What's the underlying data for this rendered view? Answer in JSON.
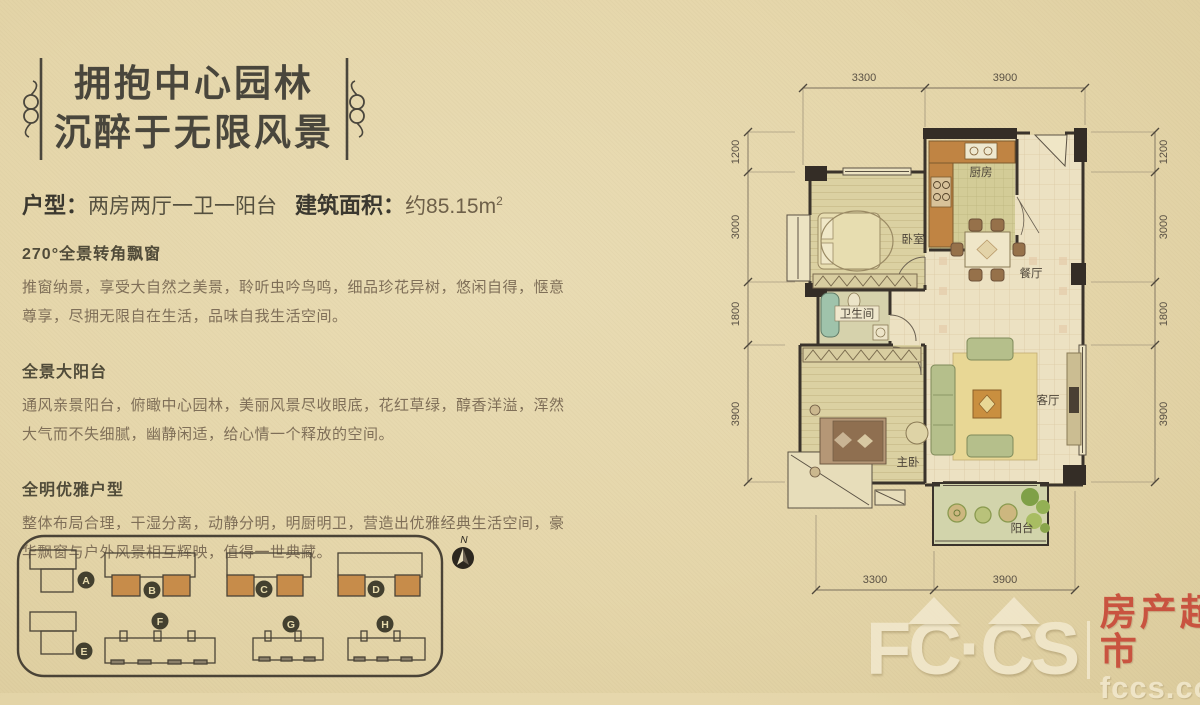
{
  "header": {
    "line1": "拥抱中心园林",
    "line2": "沉醉于无限风景"
  },
  "summary": {
    "type_label": "户型",
    "type_colon": "：",
    "type_value": "两房两厅一卫一阳台",
    "area_label": "建筑面积",
    "area_colon": "：",
    "area_value": "约85.15m",
    "area_sup": "2"
  },
  "sections": [
    {
      "heading": "270°全景转角飘窗",
      "body": "推窗纳景，享受大自然之美景，聆听虫吟鸟鸣，细品珍花异树，悠闲自得，惬意尊享，尽拥无限自在生活，品味自我生活空间。"
    },
    {
      "heading": "全景大阳台",
      "body": "通风亲景阳台，俯瞰中心园林，美丽风景尽收眼底，花红草绿，醇香洋溢，浑然大气而不失细腻，幽静闲适，给心情一个释放的空间。"
    },
    {
      "heading": "全明优雅户型",
      "body": "整体布局合理，干湿分离，动静分明，明厨明卫，营造出优雅经典生活空间，豪华飘窗与户外风景相互辉映，值得一世典藏。"
    }
  ],
  "floorplan": {
    "rooms": {
      "bedroom": "卧室",
      "kitchen": "厨房",
      "dining": "餐厅",
      "bath": "卫生间",
      "master": "主卧",
      "living": "客厅",
      "balcony": "阳台"
    },
    "dims": {
      "top": [
        "3300",
        "3900"
      ],
      "bottom": [
        "3300",
        "3900"
      ],
      "side": [
        "1200",
        "3000",
        "1800",
        "3900"
      ]
    }
  },
  "siteplan": {
    "north_label": "N",
    "buildings": [
      "A",
      "B",
      "C",
      "D",
      "E",
      "F",
      "G",
      "H"
    ],
    "highlight_color": "#c78c4a"
  },
  "logo": {
    "brand": "FC·CS",
    "name_cn": "房产超市",
    "domain": "fccs.com",
    "accent_red": "#c5392b"
  }
}
